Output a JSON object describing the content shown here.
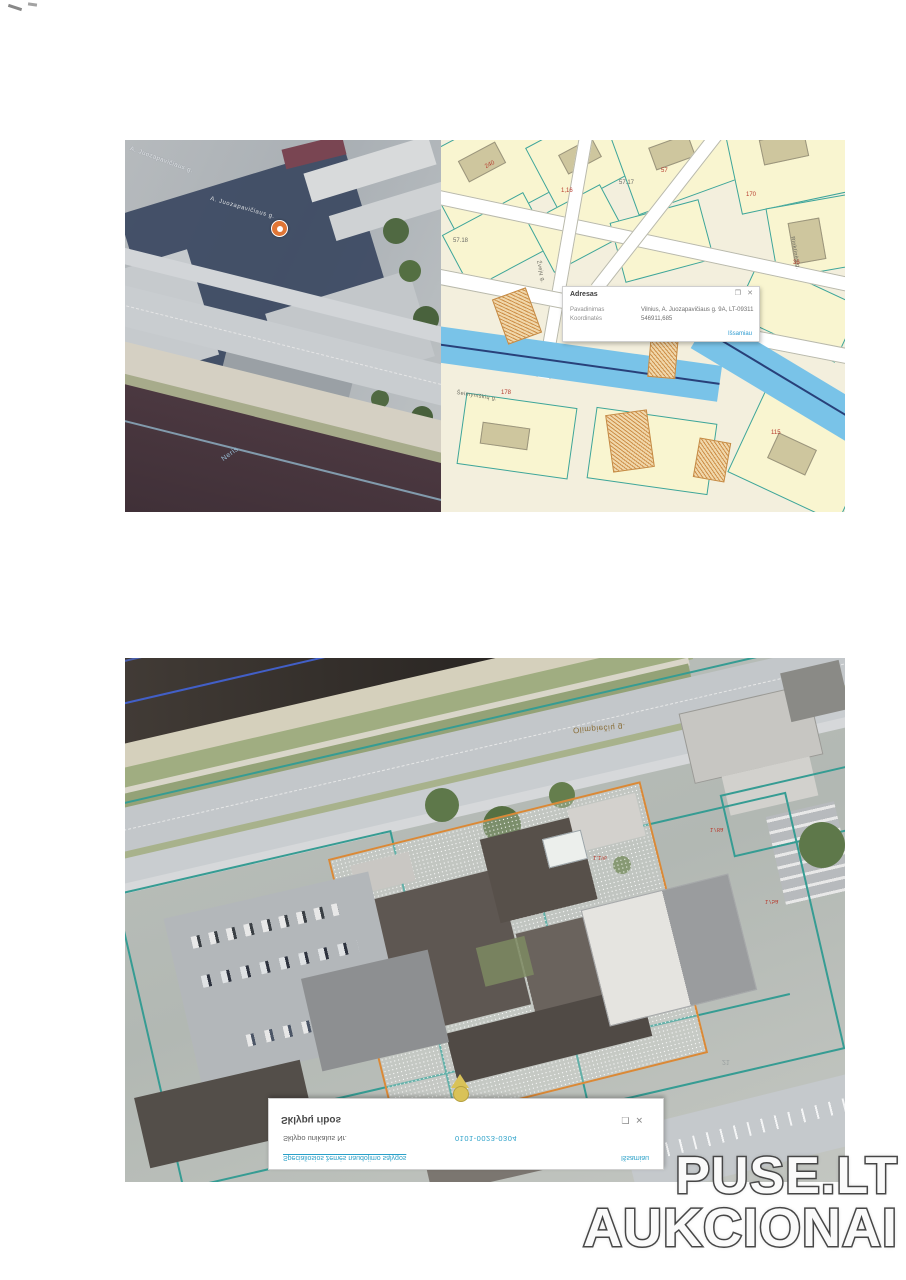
{
  "watermark": {
    "line1": "PUSE.LT",
    "line2": "AUKCIONAI"
  },
  "top_map": {
    "satellite": {
      "street_label_a": "A. Juozapavičiaus g.",
      "street_label_b": "A. Juozapavičiaus g.",
      "river_label": "Neris"
    },
    "vector": {
      "elevation_labels": [
        "57.17",
        "57.18"
      ],
      "street_labels": [
        "Žvejų g.",
        "Šeimyniškių g.",
        "Rinktinės g."
      ],
      "parcel_numbers": [
        "240",
        "1,16",
        "57",
        "170",
        "36",
        "178",
        "2,05",
        "115"
      ]
    },
    "popup": {
      "title": "Adresas",
      "rows": [
        {
          "label": "Pavadinimas",
          "value": "Vilnius, A. Juozapavičiaus g. 9A, LT-09311"
        },
        {
          "label": "Koordinatės",
          "value": "546911,685"
        }
      ],
      "more_link": "Išsamiau",
      "dock_icon": "❐",
      "close_icon": "✕"
    }
  },
  "bottom_map": {
    "street_label": "Olimpiečių g.",
    "parcel_labels": [
      "178a",
      "1.1%",
      "175a",
      "21"
    ],
    "popup": {
      "title": "Sklypų ribos",
      "row_label": "Sklypo unikalus Nr.",
      "row_value": "0101-0023-0304",
      "link": "Specialiosios žemės naudojimo sąlygos",
      "more_link": "Išsamiau",
      "dock_icon": "❐",
      "close_icon": "✕"
    }
  },
  "colors": {
    "cadastral_teal": "#2f9e94",
    "selection_orange": "#e0882f",
    "link_teal": "#2aa0c8",
    "river_blue": "#74c4ec",
    "watermark_fill": "#fafafa",
    "watermark_outline": "#4d4d4d"
  }
}
